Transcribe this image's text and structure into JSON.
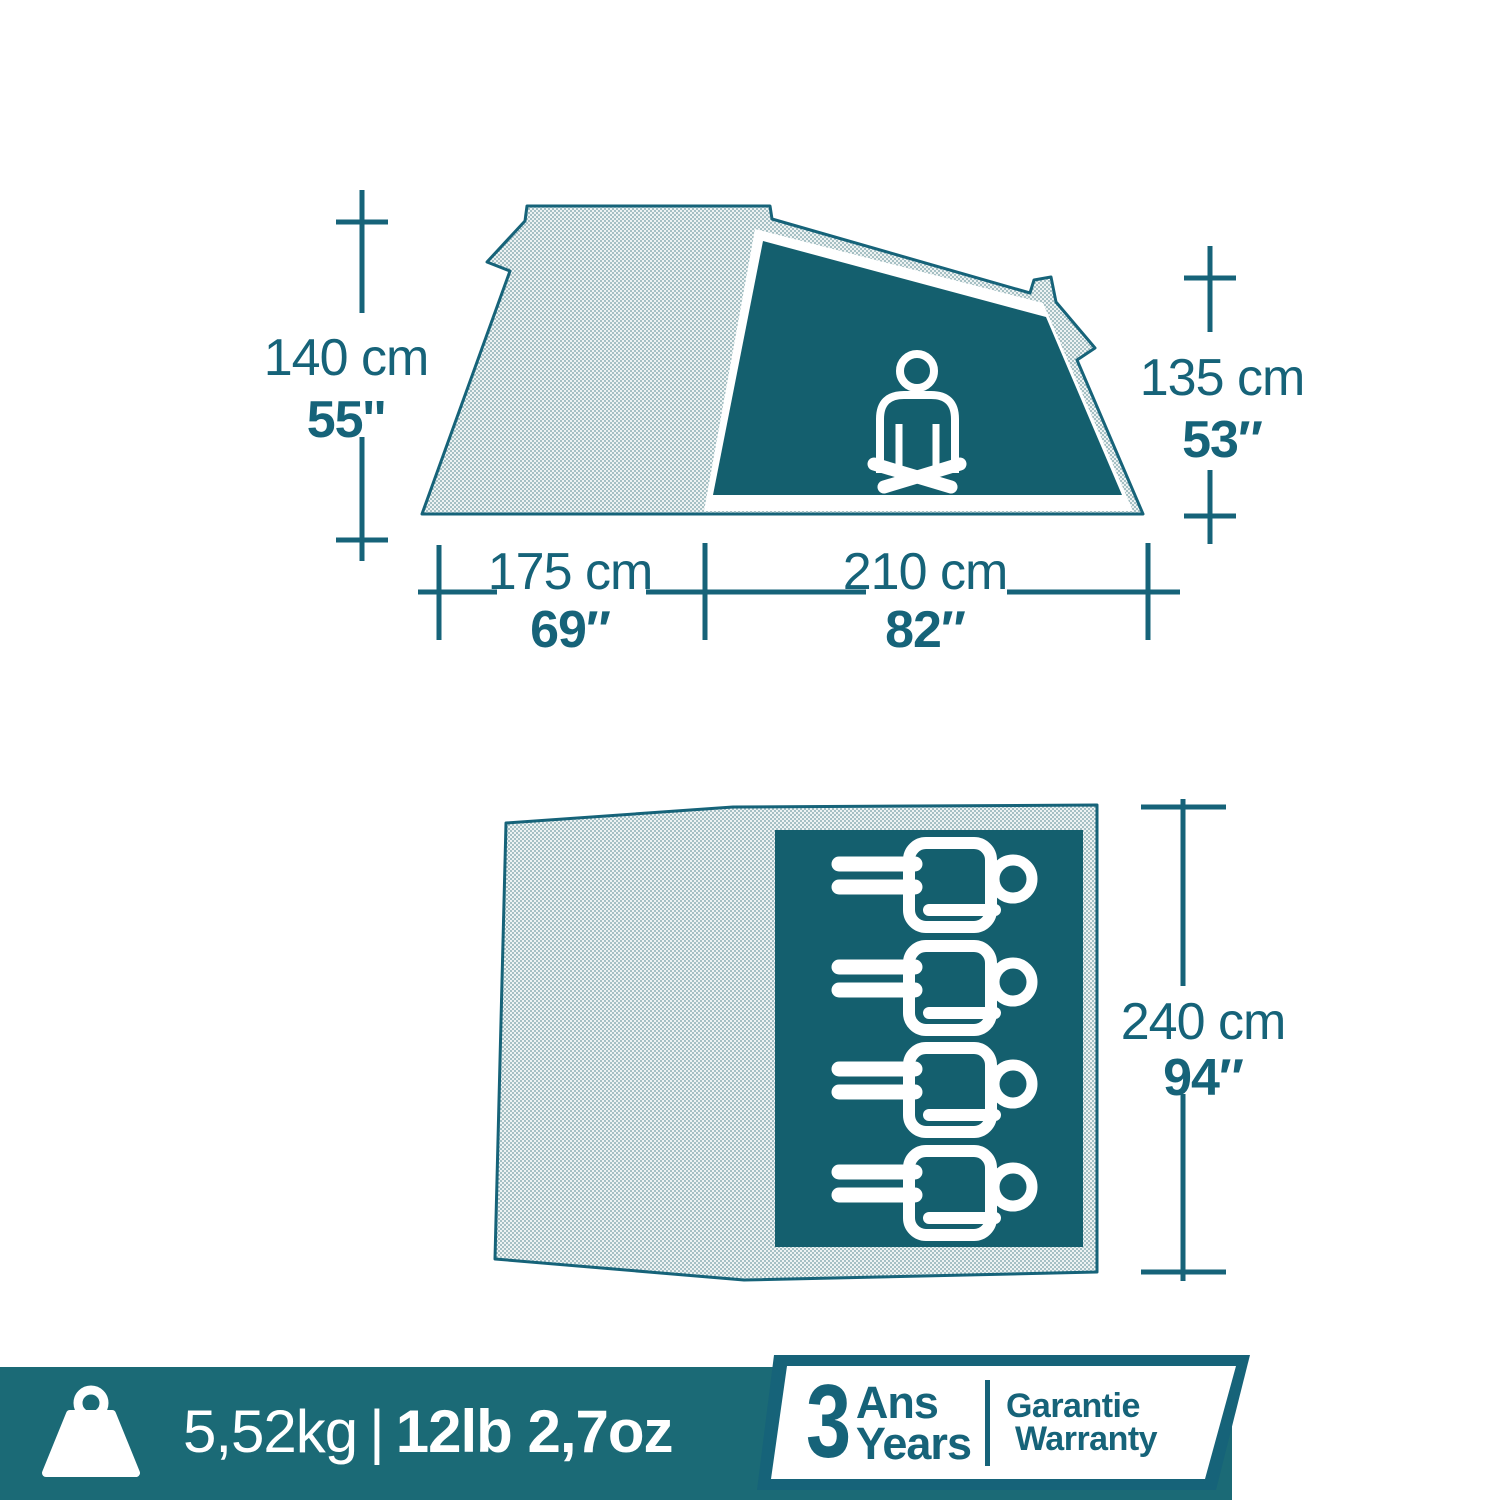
{
  "colors": {
    "teal": "#166379",
    "panel": "#145f6e",
    "bar": "#1b6a76",
    "mesh-bg": "#eef3f3",
    "mesh-dot": "#8fb0b6"
  },
  "side_view": {
    "height_left_cm": "140 cm",
    "height_left_in": "55''",
    "height_right_cm": "135 cm",
    "height_right_in": "53″",
    "length_front_cm": "175 cm",
    "length_front_in": "69″",
    "length_inner_cm": "210 cm",
    "length_inner_in": "82″"
  },
  "top_view": {
    "width_cm": "240 cm",
    "width_in": "94″",
    "sleeping_capacity": 4
  },
  "footer": {
    "weight_metric": "5,52kg",
    "separator": "|",
    "weight_imperial": "12lb 2,7oz",
    "warranty_years": "3",
    "warranty_unit_fr": "Ans",
    "warranty_unit_en": "Years",
    "warranty_label_fr": "Garantie",
    "warranty_label_en": "Warranty"
  }
}
